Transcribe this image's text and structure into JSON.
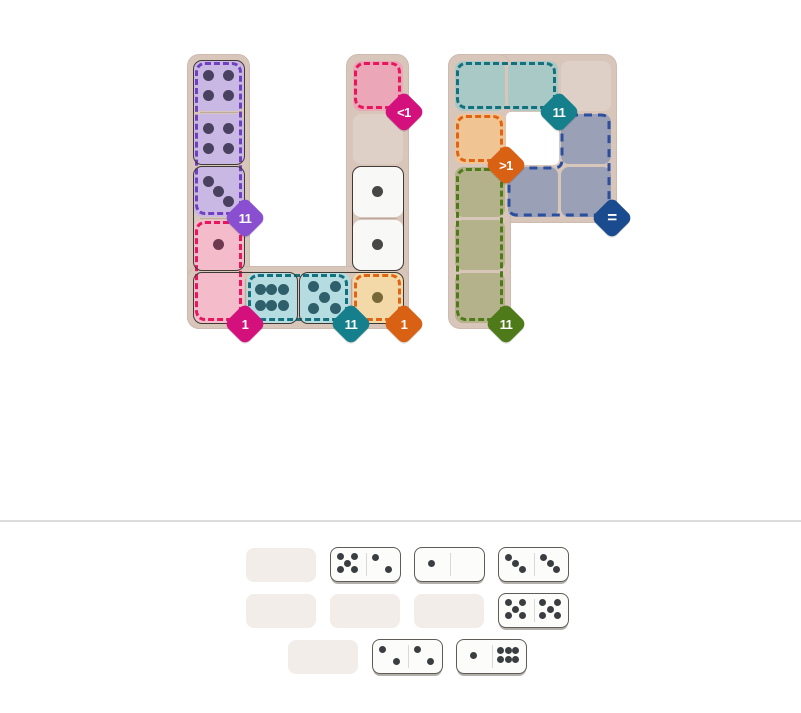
{
  "palette": {
    "board_bg": "#d9c6bb",
    "empty_cell": "#ded0c7",
    "hole": "#ffffff",
    "tray_slot": "#f3edea",
    "tray_pip": "#3b3e41",
    "page_divider": "#dcdcdc"
  },
  "boards": [
    {
      "id": "letter-u",
      "grid": {
        "x": 192,
        "y": 59,
        "cell": 53
      },
      "strips": [
        {
          "x": -5,
          "y": -5,
          "w": 63,
          "h": 275
        },
        {
          "x": 154,
          "y": -5,
          "w": 63,
          "h": 275
        },
        {
          "x": -5,
          "y": 207,
          "w": 222,
          "h": 63
        }
      ],
      "holes": [],
      "cells": [
        {
          "c": 0,
          "r": 0,
          "fill": "#cab8e4",
          "pips": 4,
          "pip_color": "#4a4060"
        },
        {
          "c": 0,
          "r": 1,
          "fill": "#cab8e4",
          "pips": 4,
          "pip_color": "#4a4060"
        },
        {
          "c": 0,
          "r": 2,
          "fill": "#cab8e4",
          "pips": 3,
          "pip_color": "#4a4060"
        },
        {
          "c": 0,
          "r": 3,
          "fill": "#f4bcca",
          "pips": 1,
          "pip_color": "#6e3850"
        },
        {
          "c": 0,
          "r": 4,
          "fill": "#f4bcca",
          "pips": 0,
          "pip_color": "#6e3850"
        },
        {
          "c": 1,
          "r": 4,
          "fill": "#b5dce0",
          "pips": 6,
          "pip_color": "#2e5f6b"
        },
        {
          "c": 2,
          "r": 4,
          "fill": "#b5dce0",
          "pips": 5,
          "pip_color": "#2e5f6b"
        },
        {
          "c": 3,
          "r": 4,
          "fill": "#f3d9a8",
          "pips": 1,
          "pip_color": "#77683a"
        },
        {
          "c": 3,
          "r": 0,
          "fill": "#eba6b8",
          "pips": 0,
          "pip_color": "#6e3850"
        },
        {
          "c": 3,
          "r": 1,
          "fill": "#ded0c7",
          "pips": 0,
          "pip_color": "#474747"
        },
        {
          "c": 3,
          "r": 2,
          "fill": "#f8f8f6",
          "pips": 1,
          "pip_color": "#474747"
        },
        {
          "c": 3,
          "r": 3,
          "fill": "#f8f8f6",
          "pips": 1,
          "pip_color": "#474747"
        }
      ],
      "regions": [
        {
          "id": "u-purple",
          "rect": {
            "c": 0,
            "r": 0,
            "w": 1,
            "h": 3
          },
          "border": "#7040c0",
          "badge": {
            "label": "11",
            "color": "#8a4fd0",
            "corner": [
              1,
              3
            ]
          }
        },
        {
          "id": "u-pink",
          "rect": {
            "c": 0,
            "r": 3,
            "w": 1,
            "h": 2
          },
          "border": "#e8175d",
          "badge": {
            "label": "1",
            "color": "#d4107c",
            "corner": [
              1,
              5
            ]
          }
        },
        {
          "id": "u-rose",
          "rect": {
            "c": 3,
            "r": 0,
            "w": 1,
            "h": 1
          },
          "border": "#e8175d",
          "badge": {
            "label": "<1",
            "color": "#d4107c",
            "corner": [
              4,
              1
            ]
          }
        },
        {
          "id": "u-teal",
          "rect": {
            "c": 1,
            "r": 4,
            "w": 2,
            "h": 1
          },
          "border": "#15707e",
          "badge": {
            "label": "11",
            "color": "#15808c",
            "corner": [
              3,
              5
            ]
          }
        },
        {
          "id": "u-cream",
          "rect": {
            "c": 3,
            "r": 4,
            "w": 1,
            "h": 1
          },
          "border": "#e06414",
          "badge": {
            "label": "1",
            "color": "#d96114",
            "corner": [
              4,
              5
            ]
          }
        }
      ],
      "dominoes": [
        {
          "name": "domino-4-4",
          "c": 0,
          "r": 0,
          "w": 1,
          "h": 2
        },
        {
          "name": "domino-3-1",
          "c": 0,
          "r": 2,
          "w": 1,
          "h": 2
        },
        {
          "name": "domino-0-6",
          "c": 0,
          "r": 4,
          "w": 2,
          "h": 1
        },
        {
          "name": "domino-5-1",
          "c": 2,
          "r": 4,
          "w": 2,
          "h": 1
        },
        {
          "name": "domino-1-1",
          "c": 3,
          "r": 2,
          "w": 1,
          "h": 2
        }
      ]
    },
    {
      "id": "letter-p",
      "grid": {
        "x": 453,
        "y": 59,
        "cell": 53
      },
      "strips": [
        {
          "x": -5,
          "y": -5,
          "w": 169,
          "h": 169
        },
        {
          "x": -5,
          "y": -5,
          "w": 63,
          "h": 275
        }
      ],
      "holes": [
        {
          "c": 1,
          "r": 1
        }
      ],
      "cells": [
        {
          "c": 0,
          "r": 0,
          "fill": "#a9c9c6",
          "pips": 0,
          "pip_color": "#2e5f6b"
        },
        {
          "c": 1,
          "r": 0,
          "fill": "#a9c9c6",
          "pips": 0,
          "pip_color": "#2e5f6b"
        },
        {
          "c": 2,
          "r": 0,
          "fill": "#ded0c7",
          "pips": 0,
          "pip_color": "#474747"
        },
        {
          "c": 0,
          "r": 1,
          "fill": "#f1c493",
          "pips": 0,
          "pip_color": "#77683a"
        },
        {
          "c": 2,
          "r": 1,
          "fill": "#9aa1b6",
          "pips": 0,
          "pip_color": "#3a4258"
        },
        {
          "c": 0,
          "r": 2,
          "fill": "#b4b28b",
          "pips": 0,
          "pip_color": "#55582e"
        },
        {
          "c": 1,
          "r": 2,
          "fill": "#9aa1b6",
          "pips": 0,
          "pip_color": "#3a4258"
        },
        {
          "c": 2,
          "r": 2,
          "fill": "#9aa1b6",
          "pips": 0,
          "pip_color": "#3a4258"
        },
        {
          "c": 0,
          "r": 3,
          "fill": "#b4b28b",
          "pips": 0,
          "pip_color": "#55582e"
        },
        {
          "c": 0,
          "r": 4,
          "fill": "#b4b28b",
          "pips": 0,
          "pip_color": "#55582e"
        }
      ],
      "regions": [
        {
          "id": "p-teal",
          "rect": {
            "c": 0,
            "r": 0,
            "w": 2,
            "h": 1
          },
          "border": "#15707e",
          "badge": {
            "label": "11",
            "color": "#15808c",
            "corner": [
              2,
              1
            ]
          }
        },
        {
          "id": "p-orange",
          "rect": {
            "c": 0,
            "r": 1,
            "w": 1,
            "h": 1
          },
          "border": "#e06414",
          "badge": {
            "label": ">1",
            "color": "#d96114",
            "corner": [
              1,
              2
            ]
          }
        },
        {
          "id": "p-blue",
          "path": "M 570 115 H 601 Q 609 115 609 123 V 207 Q 609 215 601 215 H 517 Q 509 215 509 207 V 176 Q 509 168 517 168 H 554 Q 562 168 562 160 V 123 Q 562 115 570 115 Z",
          "border": "#2b4f9e",
          "badge": {
            "label": "=",
            "color": "#1b4b8f",
            "corner": [
              3,
              3
            ],
            "eq": true
          }
        },
        {
          "id": "p-green",
          "rect": {
            "c": 0,
            "r": 2,
            "w": 1,
            "h": 3
          },
          "border": "#4e7a1a",
          "badge": {
            "label": "11",
            "color": "#4e7a1a",
            "corner": [
              1,
              5
            ]
          }
        }
      ],
      "dominoes": []
    }
  ],
  "tray": {
    "divider_y": 520,
    "top": 547,
    "pitch_x": 84,
    "pitch_y": 46,
    "rows": [
      {
        "x": 246,
        "items": [
          {
            "kind": "empty"
          },
          {
            "kind": "domino",
            "pips": [
              5,
              2
            ]
          },
          {
            "kind": "domino",
            "pips": [
              1,
              0
            ]
          },
          {
            "kind": "domino",
            "pips": [
              3,
              3
            ]
          }
        ]
      },
      {
        "x": 246,
        "items": [
          {
            "kind": "empty"
          },
          {
            "kind": "empty"
          },
          {
            "kind": "empty"
          },
          {
            "kind": "domino",
            "pips": [
              5,
              5
            ]
          }
        ]
      },
      {
        "x": 288,
        "items": [
          {
            "kind": "empty"
          },
          {
            "kind": "domino",
            "pips": [
              2,
              2
            ]
          },
          {
            "kind": "domino",
            "pips": [
              1,
              6
            ]
          }
        ]
      }
    ]
  }
}
